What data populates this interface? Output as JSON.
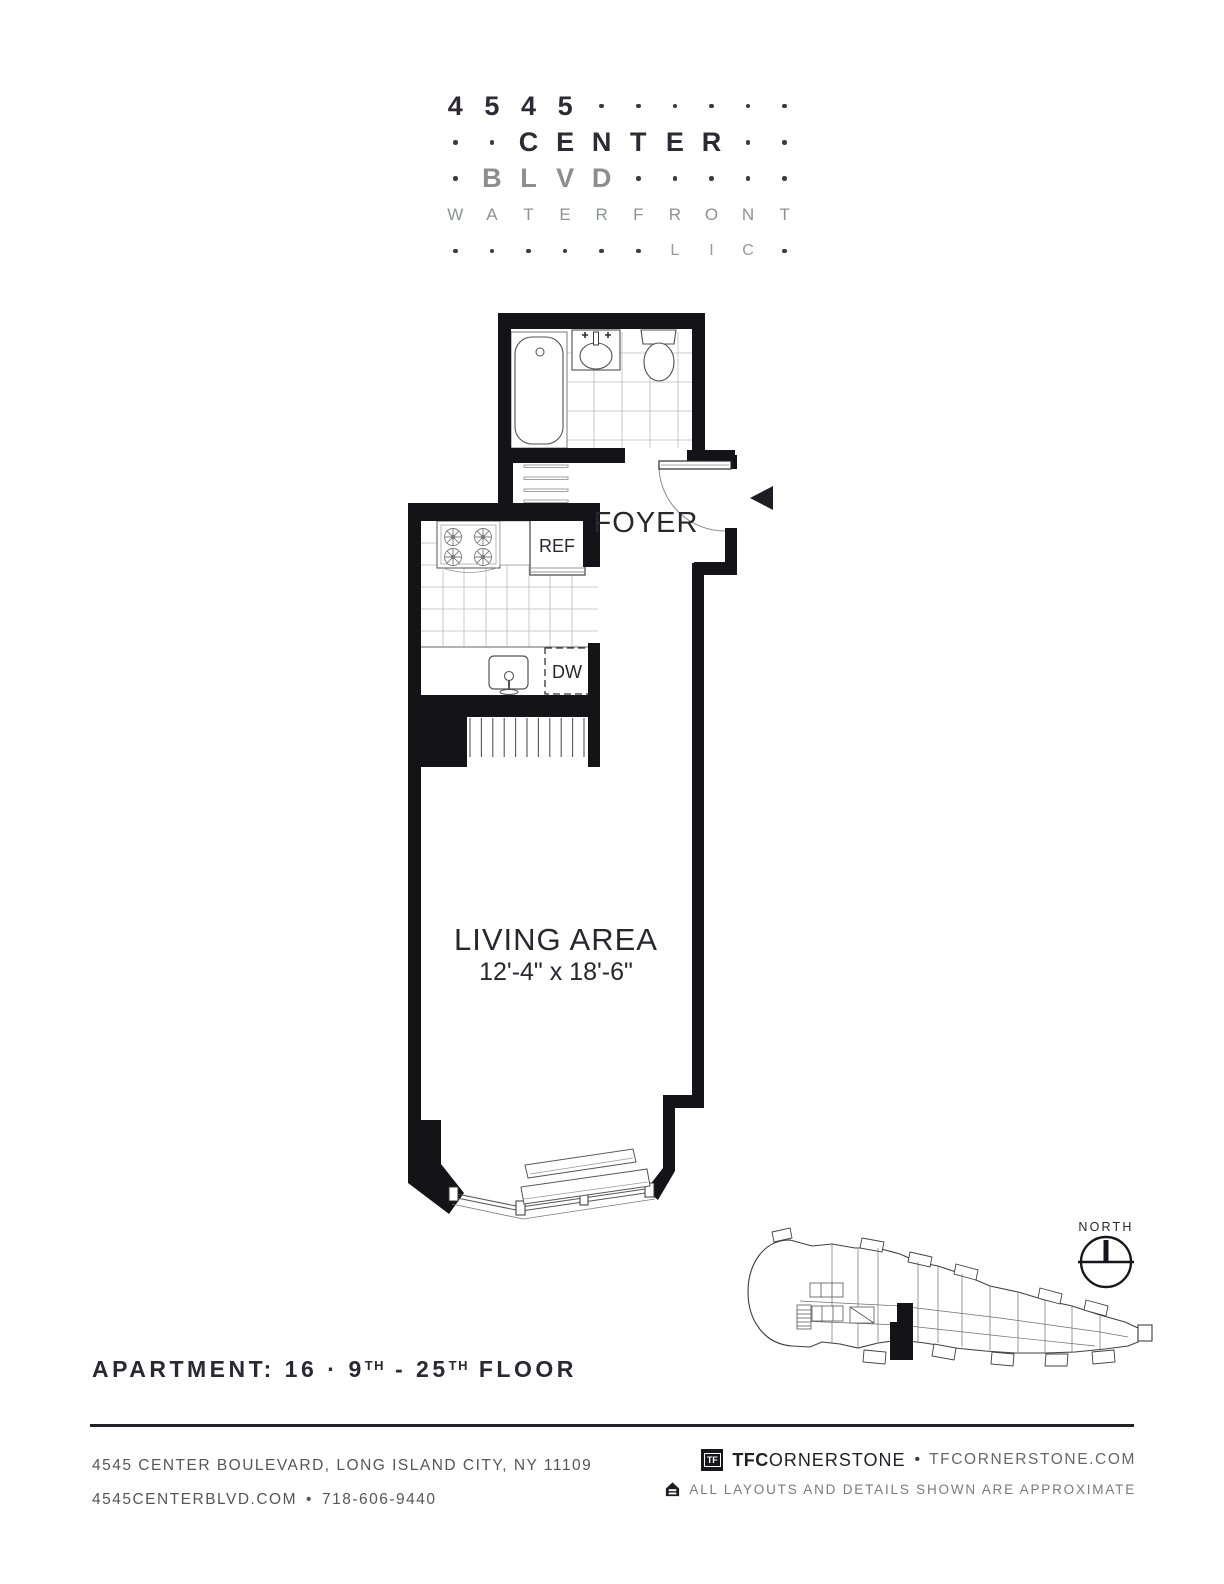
{
  "logo": {
    "rows": [
      [
        {
          "t": "4",
          "s": "b"
        },
        {
          "t": "5",
          "s": "b"
        },
        {
          "t": "4",
          "s": "b"
        },
        {
          "t": "5",
          "s": "b"
        },
        {
          "t": "",
          "s": "d"
        },
        {
          "t": "",
          "s": "d"
        },
        {
          "t": "",
          "s": "d"
        },
        {
          "t": "",
          "s": "d"
        },
        {
          "t": "",
          "s": "d"
        },
        {
          "t": "",
          "s": "d"
        }
      ],
      [
        {
          "t": "",
          "s": "d"
        },
        {
          "t": "",
          "s": "d"
        },
        {
          "t": "C",
          "s": "b"
        },
        {
          "t": "E",
          "s": "b"
        },
        {
          "t": "N",
          "s": "b"
        },
        {
          "t": "T",
          "s": "b"
        },
        {
          "t": "E",
          "s": "b"
        },
        {
          "t": "R",
          "s": "b"
        },
        {
          "t": "",
          "s": "d"
        },
        {
          "t": "",
          "s": "d"
        }
      ],
      [
        {
          "t": "",
          "s": "d"
        },
        {
          "t": "B",
          "s": "g"
        },
        {
          "t": "L",
          "s": "g"
        },
        {
          "t": "V",
          "s": "g"
        },
        {
          "t": "D",
          "s": "g"
        },
        {
          "t": "",
          "s": "d"
        },
        {
          "t": "",
          "s": "d"
        },
        {
          "t": "",
          "s": "d"
        },
        {
          "t": "",
          "s": "d"
        },
        {
          "t": "",
          "s": "d"
        }
      ],
      [
        {
          "t": "W",
          "s": "w"
        },
        {
          "t": "A",
          "s": "w"
        },
        {
          "t": "T",
          "s": "w"
        },
        {
          "t": "E",
          "s": "w"
        },
        {
          "t": "R",
          "s": "w"
        },
        {
          "t": "F",
          "s": "w"
        },
        {
          "t": "R",
          "s": "w"
        },
        {
          "t": "O",
          "s": "w"
        },
        {
          "t": "N",
          "s": "w"
        },
        {
          "t": "T",
          "s": "w"
        }
      ],
      [
        {
          "t": "",
          "s": "d"
        },
        {
          "t": "",
          "s": "d"
        },
        {
          "t": "",
          "s": "d"
        },
        {
          "t": "",
          "s": "d"
        },
        {
          "t": "",
          "s": "d"
        },
        {
          "t": "",
          "s": "d"
        },
        {
          "t": "L",
          "s": "l"
        },
        {
          "t": "I",
          "s": "l"
        },
        {
          "t": "C",
          "s": "l"
        },
        {
          "t": "",
          "s": "d"
        }
      ]
    ]
  },
  "plan": {
    "foyer_label": "FOYER",
    "ref_label": "REF",
    "dw_label": "DW",
    "living_label": "LIVING AREA",
    "living_dims": "12'-4\" x 18'-6\"",
    "north_label": "NORTH"
  },
  "apartment": {
    "prefix": "APARTMENT: 16",
    "separator": "·",
    "floor_start": "9",
    "floor_start_sup": "TH",
    "dash": "-",
    "floor_end": "25",
    "floor_end_sup": "TH",
    "suffix": "FLOOR"
  },
  "footer": {
    "address": "4545 CENTER BOULEVARD, LONG ISLAND CITY, NY 11109",
    "web": "4545CENTERBLVD.COM",
    "bullet": "•",
    "phone": "718-606-9440",
    "tf_logo": "TF",
    "brand_bold": "TFC",
    "brand_rest": "ORNERSTONE",
    "brand_dot": "•",
    "brand_site": "TFCORNERSTONE.COM",
    "disclaimer": "ALL LAYOUTS AND DETAILS SHOWN ARE APPROXIMATE"
  },
  "colors": {
    "wall": "#141318",
    "accent_dark": "#2d2a33",
    "gray_text": "#8d8d90"
  }
}
